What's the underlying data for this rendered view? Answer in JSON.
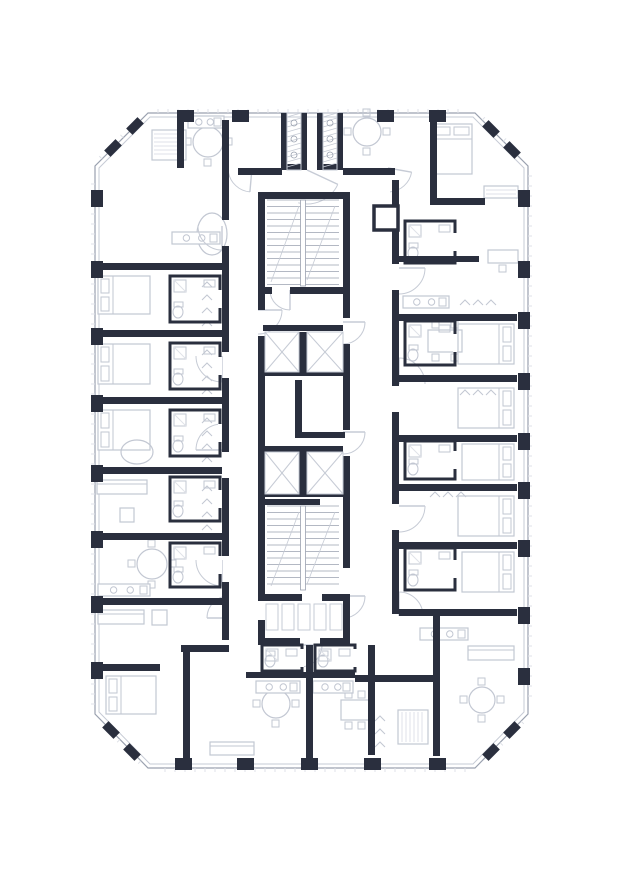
{
  "floor_plan": {
    "canvas": {
      "width": 621,
      "height": 880,
      "background": "#ffffff"
    },
    "palette": {
      "wall": "#2a2f3e",
      "facade": "#9aa1af",
      "light": "#c6cbd5",
      "furniture": "#c2c7d2",
      "faint": "#dfe2e8",
      "paper": "#ffffff"
    },
    "facade": {
      "mid": [
        [
          148,
          113
        ],
        [
          475,
          113
        ],
        [
          528,
          166
        ],
        [
          528,
          714
        ],
        [
          475,
          768
        ],
        [
          148,
          768
        ],
        [
          95,
          714
        ],
        [
          95,
          166
        ]
      ],
      "inner": [
        [
          150,
          117
        ],
        [
          473,
          117
        ],
        [
          524,
          168
        ],
        [
          524,
          712
        ],
        [
          473,
          764
        ],
        [
          150,
          764
        ],
        [
          99,
          712
        ],
        [
          99,
          168
        ]
      ]
    },
    "piers": [
      [
        177,
        110,
        17,
        12
      ],
      [
        232,
        110,
        17,
        12
      ],
      [
        377,
        110,
        17,
        12
      ],
      [
        429,
        110,
        17,
        12
      ],
      [
        175,
        758,
        17,
        12
      ],
      [
        237,
        758,
        17,
        12
      ],
      [
        301,
        758,
        17,
        12
      ],
      [
        364,
        758,
        17,
        12
      ],
      [
        429,
        758,
        17,
        12
      ],
      [
        91,
        190,
        12,
        17
      ],
      [
        91,
        261,
        12,
        17
      ],
      [
        91,
        328,
        12,
        17
      ],
      [
        91,
        395,
        12,
        17
      ],
      [
        91,
        465,
        12,
        17
      ],
      [
        91,
        531,
        12,
        17
      ],
      [
        91,
        596,
        12,
        17
      ],
      [
        91,
        662,
        12,
        17
      ],
      [
        518,
        190,
        12,
        17
      ],
      [
        518,
        261,
        12,
        17
      ],
      [
        518,
        312,
        12,
        17
      ],
      [
        518,
        373,
        12,
        17
      ],
      [
        518,
        433,
        12,
        17
      ],
      [
        518,
        482,
        12,
        17
      ],
      [
        518,
        540,
        12,
        17
      ],
      [
        518,
        607,
        12,
        17
      ],
      [
        518,
        668,
        12,
        17
      ]
    ],
    "chamfer_piers": [
      {
        "cx": 113,
        "cy": 148,
        "rot": -45
      },
      {
        "cx": 135,
        "cy": 126,
        "rot": -45
      },
      {
        "cx": 491,
        "cy": 129,
        "rot": 45
      },
      {
        "cx": 512,
        "cy": 150,
        "rot": 45
      },
      {
        "cx": 111,
        "cy": 730,
        "rot": 45
      },
      {
        "cx": 132,
        "cy": 752,
        "rot": 45
      },
      {
        "cx": 512,
        "cy": 730,
        "rot": -45
      },
      {
        "cx": 491,
        "cy": 752,
        "rot": -45
      }
    ],
    "walls": [
      [
        258,
        192,
        7,
        118
      ],
      [
        258,
        336,
        7,
        258
      ],
      [
        258,
        620,
        7,
        25
      ],
      [
        343,
        192,
        7,
        126
      ],
      [
        343,
        344,
        7,
        86
      ],
      [
        343,
        456,
        7,
        112
      ],
      [
        343,
        594,
        7,
        51
      ],
      [
        258,
        192,
        92,
        7
      ],
      [
        258,
        638,
        42,
        7
      ],
      [
        320,
        638,
        30,
        7
      ],
      [
        258,
        287,
        14,
        7
      ],
      [
        290,
        287,
        60,
        7
      ],
      [
        263,
        325,
        80,
        6
      ],
      [
        299,
        332,
        8,
        42
      ],
      [
        263,
        370,
        80,
        6
      ],
      [
        295,
        380,
        7,
        58
      ],
      [
        295,
        432,
        50,
        6
      ],
      [
        263,
        446,
        80,
        6
      ],
      [
        299,
        452,
        8,
        42
      ],
      [
        263,
        490,
        80,
        7
      ],
      [
        263,
        499,
        57,
        6
      ],
      [
        258,
        594,
        44,
        7
      ],
      [
        322,
        594,
        28,
        7
      ],
      [
        281,
        113,
        6,
        57
      ],
      [
        301,
        113,
        6,
        57
      ],
      [
        317,
        113,
        6,
        57
      ],
      [
        337,
        113,
        6,
        57
      ],
      [
        281,
        164,
        26,
        6
      ],
      [
        317,
        164,
        26,
        6
      ],
      [
        238,
        168,
        44,
        7
      ],
      [
        343,
        168,
        52,
        7
      ],
      [
        222,
        120,
        7,
        100
      ],
      [
        222,
        246,
        7,
        106
      ],
      [
        222,
        378,
        7,
        74
      ],
      [
        222,
        478,
        7,
        78
      ],
      [
        222,
        582,
        7,
        58
      ],
      [
        95,
        263,
        127,
        7
      ],
      [
        95,
        330,
        127,
        7
      ],
      [
        95,
        397,
        127,
        7
      ],
      [
        95,
        467,
        127,
        7
      ],
      [
        95,
        533,
        127,
        7
      ],
      [
        95,
        598,
        127,
        7
      ],
      [
        177,
        113,
        7,
        55
      ],
      [
        95,
        664,
        65,
        7
      ],
      [
        181,
        645,
        48,
        7
      ],
      [
        183,
        652,
        7,
        106
      ],
      [
        392,
        180,
        7,
        84
      ],
      [
        392,
        290,
        7,
        96
      ],
      [
        392,
        412,
        7,
        92
      ],
      [
        392,
        530,
        7,
        84
      ],
      [
        399,
        314,
        118,
        7
      ],
      [
        399,
        375,
        118,
        7
      ],
      [
        399,
        435,
        118,
        7
      ],
      [
        399,
        484,
        118,
        7
      ],
      [
        399,
        542,
        118,
        7
      ],
      [
        399,
        609,
        118,
        7
      ],
      [
        430,
        113,
        7,
        92
      ],
      [
        430,
        198,
        55,
        7
      ],
      [
        399,
        256,
        80,
        6
      ],
      [
        306,
        645,
        7,
        113
      ],
      [
        368,
        645,
        7,
        110
      ],
      [
        433,
        616,
        7,
        140
      ],
      [
        355,
        675,
        82,
        7
      ],
      [
        246,
        672,
        109,
        6
      ]
    ],
    "shafts": [
      [
        265,
        332,
        34,
        40
      ],
      [
        307,
        332,
        36,
        40
      ],
      [
        265,
        452,
        34,
        42
      ],
      [
        307,
        452,
        36,
        42
      ]
    ],
    "stairs": [
      {
        "x": 267,
        "y": 200,
        "w": 72,
        "h": 86
      },
      {
        "x": 267,
        "y": 506,
        "w": 72,
        "h": 84
      }
    ],
    "vents": [
      [
        287,
        113,
        14,
        57
      ],
      [
        323,
        113,
        14,
        57
      ]
    ],
    "ducts": [
      [
        374,
        206,
        24,
        24
      ]
    ],
    "bath_boxes": [
      [
        170,
        276,
        50,
        46
      ],
      [
        170,
        343,
        50,
        46
      ],
      [
        170,
        410,
        50,
        46
      ],
      [
        170,
        477,
        50,
        44
      ],
      [
        170,
        543,
        50,
        44
      ],
      [
        405,
        221,
        50,
        42
      ],
      [
        405,
        321,
        50,
        44
      ],
      [
        405,
        441,
        50,
        38
      ],
      [
        405,
        548,
        50,
        42
      ],
      [
        262,
        645,
        40,
        26
      ],
      [
        315,
        645,
        40,
        26
      ]
    ],
    "doors": [
      [
        222,
        226,
        24,
        90,
        180
      ],
      [
        222,
        356,
        26,
        90,
        180
      ],
      [
        222,
        450,
        26,
        180,
        270
      ],
      [
        222,
        560,
        26,
        90,
        180
      ],
      [
        399,
        268,
        26,
        0,
        90
      ],
      [
        399,
        384,
        26,
        270,
        360
      ],
      [
        399,
        506,
        26,
        0,
        90
      ],
      [
        399,
        616,
        24,
        270,
        360
      ],
      [
        290,
        290,
        20,
        90,
        180
      ],
      [
        343,
        322,
        22,
        0,
        90
      ],
      [
        343,
        432,
        22,
        0,
        90
      ],
      [
        343,
        596,
        22,
        0,
        90
      ],
      [
        307,
        170,
        34,
        25,
        105
      ],
      [
        300,
        645,
        22,
        0,
        90
      ],
      [
        229,
        618,
        22,
        180,
        270
      ],
      [
        252,
        168,
        24,
        95,
        170
      ],
      [
        388,
        168,
        24,
        10,
        85
      ],
      [
        258,
        310,
        24,
        0,
        90
      ]
    ],
    "slots": [
      {
        "x": 266,
        "y": 604,
        "n": 5,
        "w": 12,
        "h": 26,
        "gap": 16
      }
    ],
    "furniture": [
      {
        "t": "bed",
        "x": 98,
        "y": 276,
        "w": 52,
        "h": 38,
        "head": "l"
      },
      {
        "t": "bed",
        "x": 98,
        "y": 344,
        "w": 52,
        "h": 40,
        "head": "l"
      },
      {
        "t": "bed",
        "x": 98,
        "y": 410,
        "w": 52,
        "h": 40,
        "head": "l"
      },
      {
        "t": "bed",
        "x": 106,
        "y": 676,
        "w": 50,
        "h": 38,
        "head": "l"
      },
      {
        "t": "bed",
        "x": 458,
        "y": 324,
        "w": 56,
        "h": 40,
        "head": "r"
      },
      {
        "t": "bed",
        "x": 458,
        "y": 388,
        "w": 56,
        "h": 40,
        "head": "r"
      },
      {
        "t": "bed",
        "x": 462,
        "y": 444,
        "w": 52,
        "h": 36,
        "head": "r"
      },
      {
        "t": "bed",
        "x": 458,
        "y": 496,
        "w": 56,
        "h": 40,
        "head": "r"
      },
      {
        "t": "bed",
        "x": 462,
        "y": 552,
        "w": 52,
        "h": 40,
        "head": "r"
      },
      {
        "t": "bed",
        "x": 432,
        "y": 124,
        "w": 40,
        "h": 50,
        "head": "t"
      },
      {
        "t": "sofa",
        "x": 97,
        "y": 480,
        "w": 50,
        "h": 14
      },
      {
        "t": "sofa",
        "x": 98,
        "y": 610,
        "w": 46,
        "h": 14
      },
      {
        "t": "sofa",
        "x": 468,
        "y": 646,
        "w": 46,
        "h": 14
      },
      {
        "t": "sofa",
        "x": 210,
        "y": 742,
        "w": 44,
        "h": 13
      },
      {
        "t": "rtable",
        "x": 208,
        "y": 142,
        "r": 15
      },
      {
        "t": "rtable",
        "x": 152,
        "y": 564,
        "r": 15
      },
      {
        "t": "rtable",
        "x": 276,
        "y": 704,
        "r": 14
      },
      {
        "t": "rtable",
        "x": 482,
        "y": 700,
        "r": 13
      },
      {
        "t": "rtable",
        "x": 367,
        "y": 132,
        "r": 14
      },
      {
        "t": "table",
        "x": 428,
        "y": 330,
        "w": 34,
        "h": 22
      },
      {
        "t": "table",
        "x": 341,
        "y": 700,
        "w": 28,
        "h": 20
      },
      {
        "t": "desk",
        "x": 488,
        "y": 250,
        "w": 30,
        "h": 13
      },
      {
        "t": "wardrobe",
        "x": 152,
        "y": 130,
        "w": 34,
        "h": 30
      },
      {
        "t": "wardrobe",
        "x": 398,
        "y": 710,
        "w": 30,
        "h": 34
      },
      {
        "t": "wardrobe",
        "x": 484,
        "y": 186,
        "w": 34,
        "h": 12
      },
      {
        "t": "tubo",
        "x": 212,
        "y": 234,
        "rx": 15,
        "ry": 21
      },
      {
        "t": "tubo",
        "x": 137,
        "y": 452,
        "rx": 16,
        "ry": 12
      },
      {
        "t": "kitchen",
        "x": 172,
        "y": 232,
        "w": 48,
        "h": 12
      },
      {
        "t": "kitchen",
        "x": 98,
        "y": 584,
        "w": 52,
        "h": 12
      },
      {
        "t": "kitchen",
        "x": 256,
        "y": 681,
        "w": 44,
        "h": 12
      },
      {
        "t": "kitchen",
        "x": 313,
        "y": 681,
        "w": 40,
        "h": 12
      },
      {
        "t": "kitchen",
        "x": 403,
        "y": 296,
        "w": 46,
        "h": 12
      },
      {
        "t": "kitchen",
        "x": 420,
        "y": 628,
        "w": 48,
        "h": 12
      },
      {
        "t": "kitchen",
        "x": 188,
        "y": 116,
        "w": 36,
        "h": 12
      },
      {
        "t": "hangers",
        "x": 202,
        "y": 282,
        "n": 4,
        "dir": "v"
      },
      {
        "t": "hangers",
        "x": 202,
        "y": 350,
        "n": 4,
        "dir": "v"
      },
      {
        "t": "hangers",
        "x": 202,
        "y": 418,
        "n": 4,
        "dir": "v"
      },
      {
        "t": "hangers",
        "x": 202,
        "y": 486,
        "n": 4,
        "dir": "v"
      },
      {
        "t": "hangers",
        "x": 460,
        "y": 300,
        "n": 3,
        "dir": "h"
      },
      {
        "t": "hangers",
        "x": 460,
        "y": 390,
        "n": 3,
        "dir": "h"
      },
      {
        "t": "hangers",
        "x": 430,
        "y": 492,
        "n": 3,
        "dir": "h"
      },
      {
        "t": "hangers",
        "x": 375,
        "y": 716,
        "n": 3,
        "dir": "v"
      },
      {
        "t": "chair",
        "x": 152,
        "y": 610,
        "w": 15,
        "h": 15
      },
      {
        "t": "chair",
        "x": 120,
        "y": 508,
        "w": 14,
        "h": 14
      }
    ]
  }
}
